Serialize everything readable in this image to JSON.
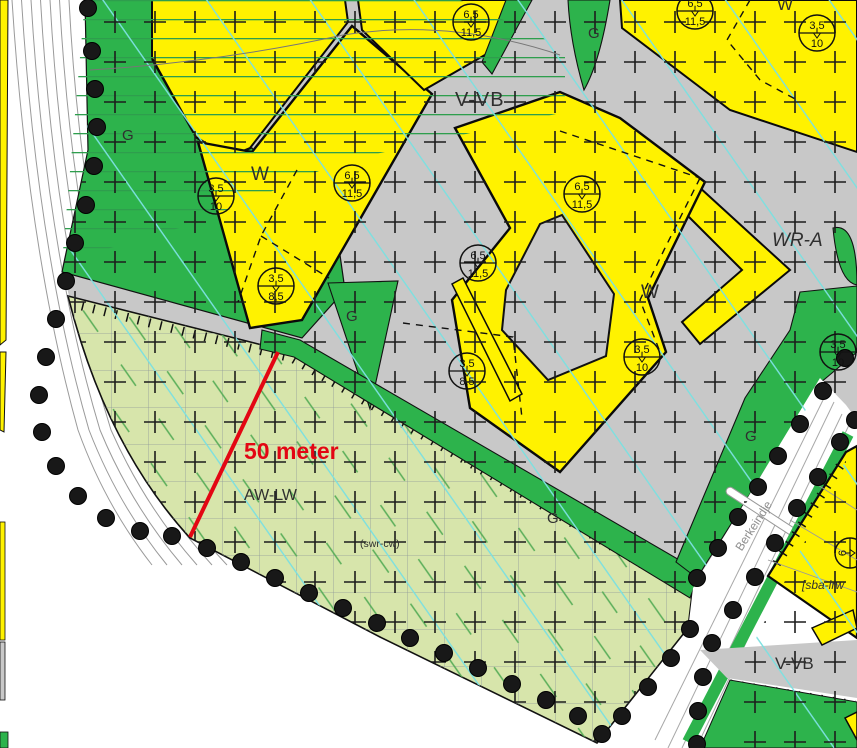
{
  "map": {
    "region_labels": {
      "v_vb_top": "V-VB",
      "v_vb_bottom_right": "V-VB",
      "wr_a": "WR-A",
      "aw_lw": "AW-LW",
      "w_left": "W",
      "w_center": "W",
      "w_top_right": "W",
      "g_left": "G",
      "g_top_center": "G",
      "g_center_triangle": "G",
      "g_south_strip": "G",
      "g_east_strip": "G",
      "swr_cw": "(swr-cw)",
      "sba_lrw": "[sba-lrw",
      "street_name": "Berkeindje"
    },
    "annotation": {
      "distance_label": "50 meter"
    },
    "height_markers": [
      {
        "top": "6,5",
        "bottom": "11,5"
      },
      {
        "top": "6,5",
        "bottom": "11,5"
      },
      {
        "top": "3,5",
        "bottom": "10"
      },
      {
        "top": "3,5",
        "bottom": "10"
      },
      {
        "top": "6,5",
        "bottom": "11,5"
      },
      {
        "top": "6,5",
        "bottom": "11,5"
      },
      {
        "top": "6,5",
        "bottom": "11,5"
      },
      {
        "top": "3,5",
        "bottom": "8,5"
      },
      {
        "top": "3,5",
        "bottom": "8,5"
      },
      {
        "top": "3,5",
        "bottom": "10"
      },
      {
        "top": "3,5",
        "bottom": "10"
      },
      {
        "top": "6",
        "bottom": "9"
      }
    ],
    "colors": {
      "residential_yellow": "#fff200",
      "public_green": "#2db34c",
      "road_gray": "#c8c8c8",
      "agrarian_light_green": "#d7e5ab",
      "measure_red": "#e30613",
      "cyan_grid_line": "#7ce0e0",
      "boundary_black": "#111111"
    }
  }
}
